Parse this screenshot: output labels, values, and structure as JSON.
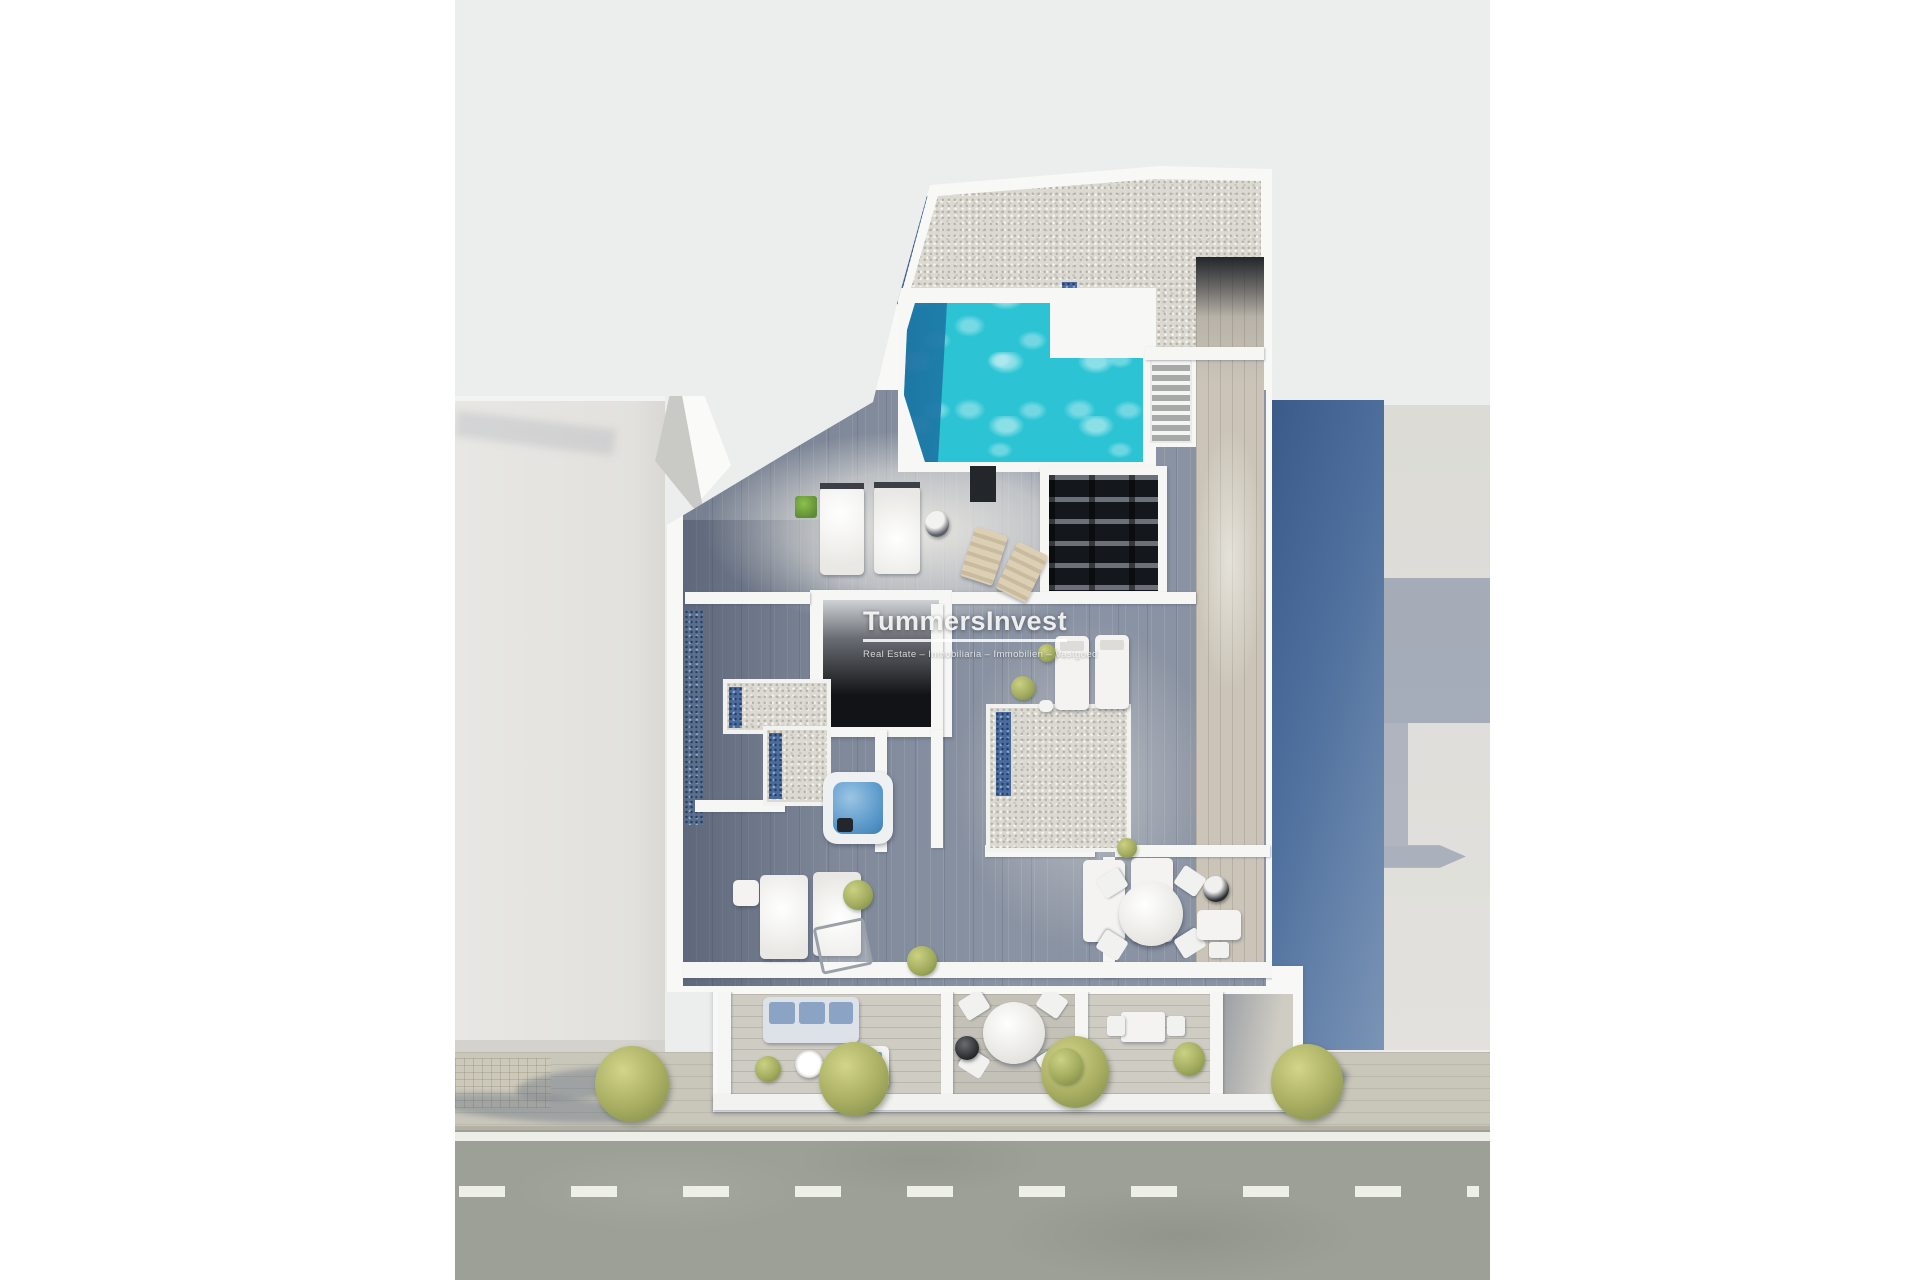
{
  "image": {
    "kind": "3d-architectural-render",
    "description": "Top-down aerial render of a new-build apartment roof level with rooftop pool, gravel flat roof, cutaway furnished floor plan, street with sidewalk and trees below, neighbouring rooftops left and right"
  },
  "watermark": {
    "title": "TummersInvest",
    "subtitle": "Real Estate – Inmobiliaria – Immobilien – Vastgoed"
  },
  "palette": {
    "page_background": "#ffffff",
    "scene_background": "#eceded",
    "pool_water": "#2cc4d4",
    "pool_deep": "#1b6fa0",
    "gravel_roof": "#dbd9d1",
    "blue_gravel_border": "#4a6b9e",
    "shaded_wood_floor": "#8a93a3",
    "deck_wood": "#cbc5b9",
    "white_walls": "#f6f6f4",
    "neighbor_wall_blue": "#3f5f8d",
    "street_asphalt": "#9ca096",
    "sidewalk": "#c9c6ba",
    "tree_foliage": "#a8ad61"
  },
  "scene_objects": {
    "pool": "rooftop swimming pool",
    "jacuzzi": "hot tub",
    "stairs": "roof access staircase",
    "loungers": "sun loungers",
    "dining_table": "round terrace dining table",
    "sofa": "balcony lounge sofa",
    "trees": "street trees",
    "road_markings": "dashed center line"
  }
}
